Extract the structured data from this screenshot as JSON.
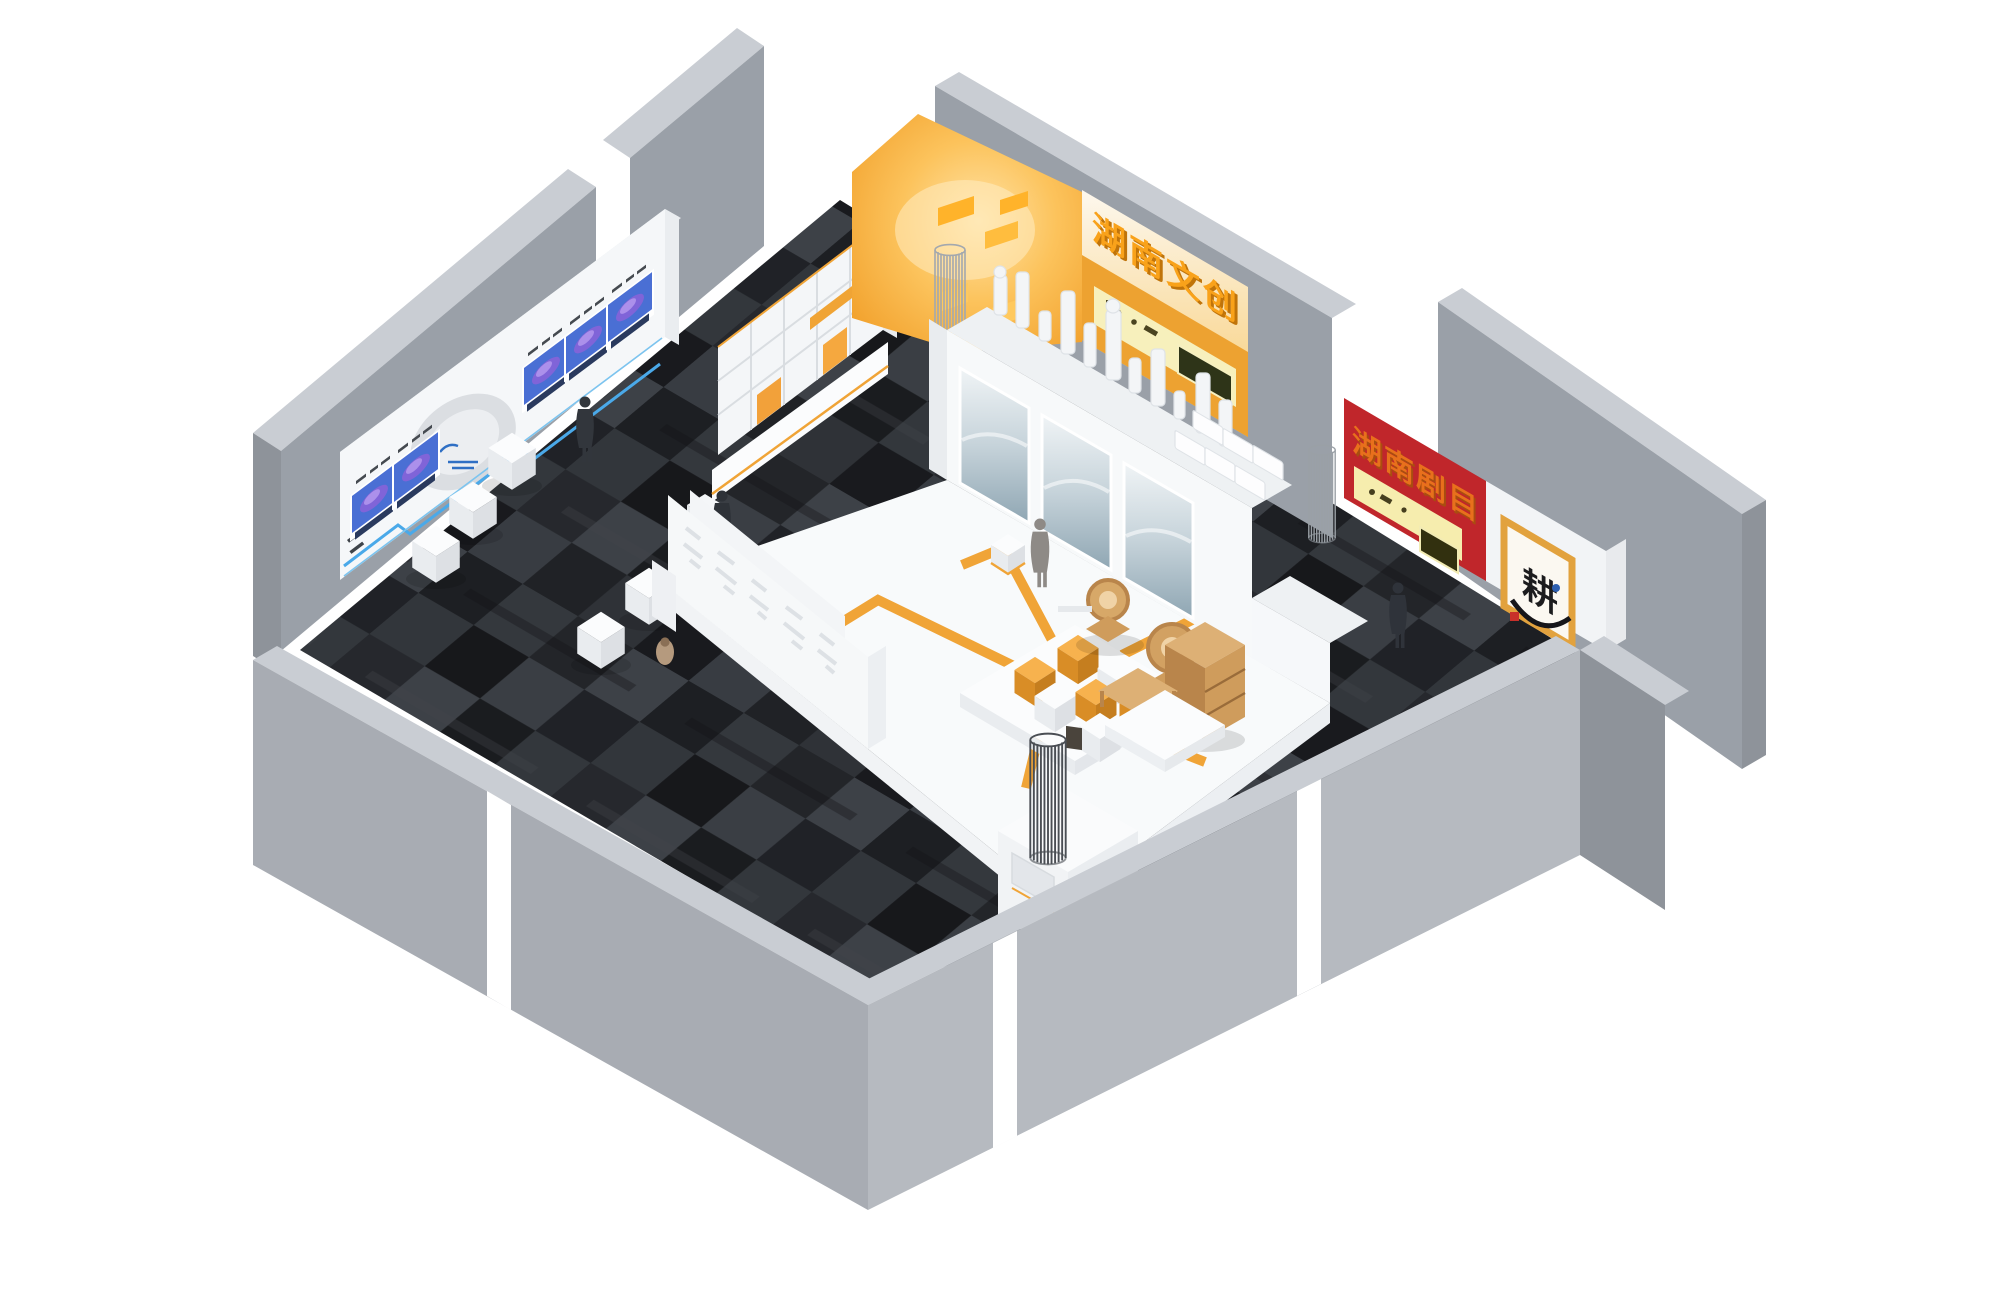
{
  "scene": {
    "background": "#ffffff"
  },
  "signs": {
    "top_wall": {
      "text": "湖南文创",
      "fill": "#f9a21a",
      "extrude": "#c0740a"
    },
    "right_wall": {
      "text": "湖南剧目",
      "fill": "#e8701c",
      "extrude": "#a94d10"
    },
    "artwork": {
      "text": "耕",
      "ink": "#1c1c1e",
      "seal": "#c8302a",
      "frame": "#e2a23e"
    }
  },
  "palette": {
    "accent_orange": "#f0a437",
    "glow_orange": "#f6a92f",
    "alcove_glow": "#ffe3a6",
    "orange_wall": "#eda231",
    "red_wall": "#c0262b",
    "case_glow": "#f6efae",
    "wall_gray": "#9aa0a8",
    "wall_gray_top": "#c9cdd3",
    "carpet_dark": "#26282c",
    "platform_white": "#f8fafb",
    "wood": "#cf9c5c",
    "blue_accent": "#4aa9e9",
    "screen_blue": "#4a6fd4",
    "emblem_gray": "#d9dce0"
  },
  "counts": {
    "wall_screens": 5,
    "seat_cubes": 5,
    "wire_columns": 4,
    "people": 5,
    "trays": 6,
    "mural_panels": 3,
    "crest_shapes": 13,
    "table_cubes": 7
  }
}
